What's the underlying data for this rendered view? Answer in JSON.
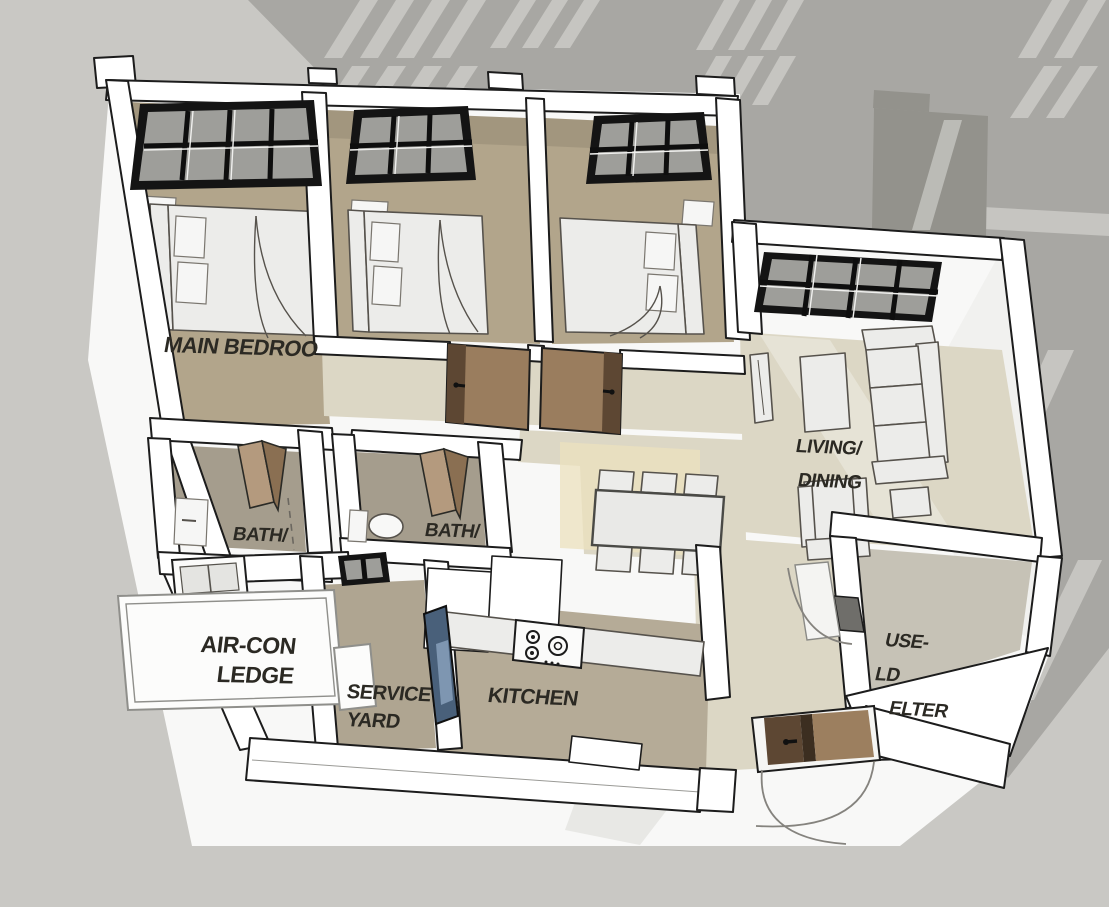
{
  "scene": {
    "kind": "isometric-apartment-floor-plan-render"
  },
  "rooms": {
    "main_bedroom": {
      "label": "MAIN BEDROO"
    },
    "bath1": {
      "label": "BATH/"
    },
    "bath2": {
      "label": "BATH/"
    },
    "living_dining": {
      "line1": "LIVING/",
      "line2": "DINING"
    },
    "aircon_ledge": {
      "line1": "AIR-CON",
      "line2": "LEDGE"
    },
    "service_yard": {
      "line1": "SERVICE",
      "line2": "YARD"
    },
    "kitchen": {
      "label": "KITCHEN"
    },
    "household_shelter": {
      "line1": "USE-",
      "line2": "LD",
      "line3": "ELTER"
    }
  },
  "colors": {
    "background": "#c9c8c4",
    "building_shadow": "#a8a7a3",
    "building_shadow_dark": "#93928c",
    "shadow_window_highlight": "#c6c5c1",
    "ground_plane": "#f8f8f7",
    "wall_fill": "#ffffff",
    "wall_line": "#1c1c1c",
    "bedroom_floor": "#b2a58b",
    "bath_floor": "#a59d8d",
    "living_floor": "#dcd7c5",
    "warm_floor_patch": "#ece1bd",
    "kitchen_floor": "#b5ab97",
    "service_yard_floor": "#afa591",
    "shelter_floor": "#c6c2b6",
    "door_brown": "#9a7d5e",
    "door_brown_dark": "#5d4733",
    "glass_door_blue": "#49607a",
    "glass_door_blue_light": "#7e96b1",
    "window_frame": "#141414",
    "window_glass": "#9e9e9a",
    "label_text": "#2b2923"
  }
}
